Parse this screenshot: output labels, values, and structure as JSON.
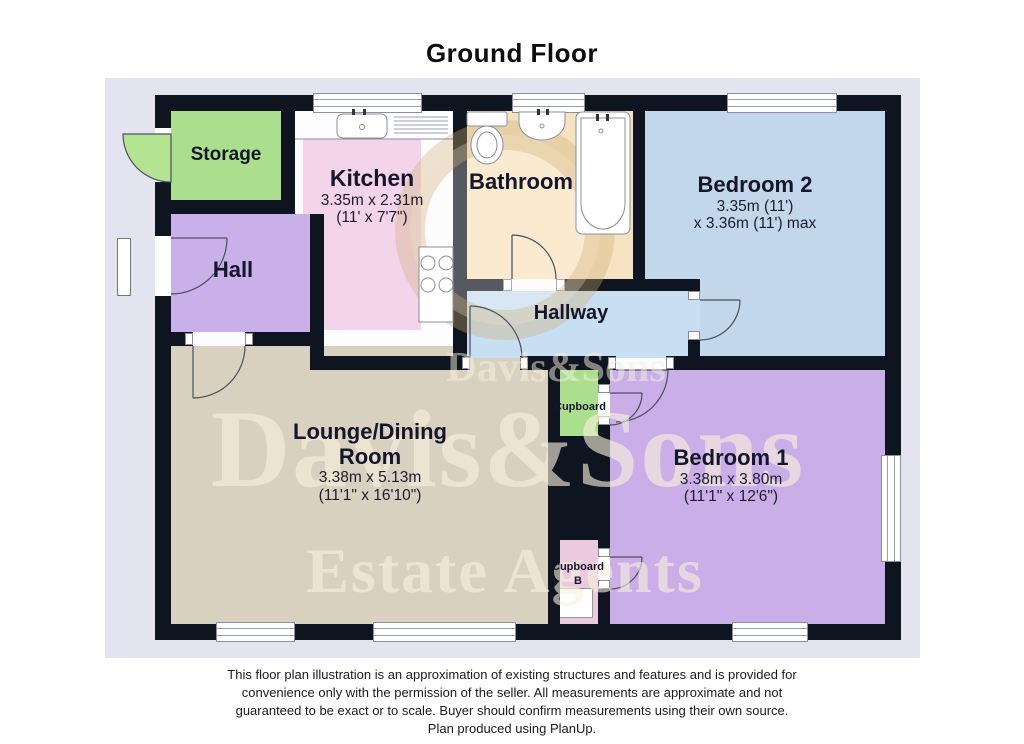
{
  "title": "Ground Floor",
  "watermark": {
    "mid_line": "Davis&Sons",
    "big_line": "Davis&Sons",
    "bottom_line": "Estate Agents"
  },
  "rooms": {
    "storage": {
      "label": "Storage"
    },
    "kitchen": {
      "label": "Kitchen",
      "dim_m": "3.35m x 2.31m",
      "dim_ft": "(11' x 7'7\")"
    },
    "bathroom": {
      "label": "Bathroom"
    },
    "bedroom2": {
      "label": "Bedroom 2",
      "dim_m": "3.35m (11')",
      "dim_ft": "x 3.36m (11') max"
    },
    "hall": {
      "label": "Hall"
    },
    "hallway": {
      "label": "Hallway"
    },
    "lounge": {
      "label": "Lounge/Dining",
      "label2": "Room",
      "dim_m": "3.38m x 5.13m",
      "dim_ft": "(11'1\" x 16'10\")"
    },
    "cupboard": {
      "label": "Cupboard"
    },
    "cupboard_b": {
      "label": "Cupboard",
      "label2": "B"
    },
    "bedroom1": {
      "label": "Bedroom 1",
      "dim_m": "3.38m x 3.80m",
      "dim_ft": "(11'1\" x 12'6\")"
    }
  },
  "colors": {
    "plan_background": "#e3e4f0",
    "wall": "#0e1420",
    "storage_green": "#abdf8d",
    "kitchen_pink": "#f3d4ea",
    "bathroom_tan": "#f6e2c0",
    "bedroom2_blue": "#c2d7eb",
    "hallway_blue": "#c8def2",
    "hall_purple": "#c9b0e8",
    "lounge_tan": "#d9d1c0",
    "cupboard_b_pink": "#ebc9de",
    "bedroom1_purple": "#c9aee8",
    "watermark_cream": "#f8f1dc"
  },
  "footer": {
    "line1": "This floor plan illustration is an approximation of existing structures and features and is provided for",
    "line2": "convenience only with the permission of the seller. All measurements are approximate and not",
    "line3": "guaranteed to be exact or to scale.  Buyer should confirm measurements using their own source.",
    "line4": "Plan produced using PlanUp."
  }
}
